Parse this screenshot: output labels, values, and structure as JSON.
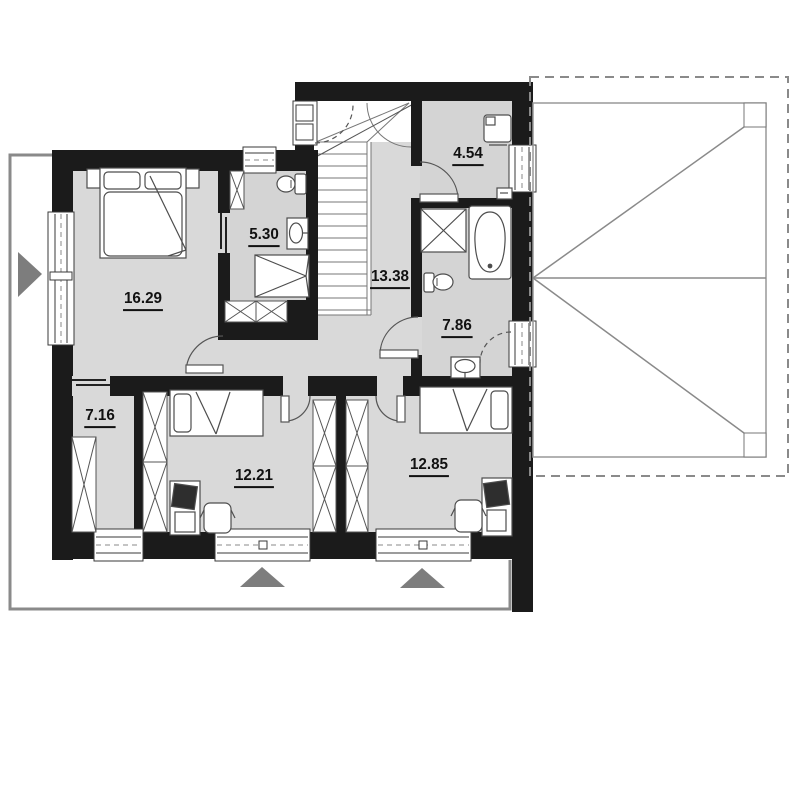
{
  "floor_plan": {
    "type": "upper-floor architectural plan",
    "rooms": [
      {
        "id": "bedroom-master",
        "area": "16.29"
      },
      {
        "id": "bathroom-ensuite",
        "area": "5.30"
      },
      {
        "id": "utility-room",
        "area": "4.54"
      },
      {
        "id": "hall-staircase",
        "area": "13.38"
      },
      {
        "id": "bathroom-main",
        "area": "7.86"
      },
      {
        "id": "wardrobe-room",
        "area": "7.16"
      },
      {
        "id": "bedroom-child-1",
        "area": "12.21"
      },
      {
        "id": "bedroom-child-2",
        "area": "12.85"
      }
    ],
    "colors": {
      "wall": "#1b1b1b",
      "floor": "#d9d9d9",
      "outline_gray": "#8a8a8a",
      "triangle_gray": "#7d7d7d"
    }
  }
}
